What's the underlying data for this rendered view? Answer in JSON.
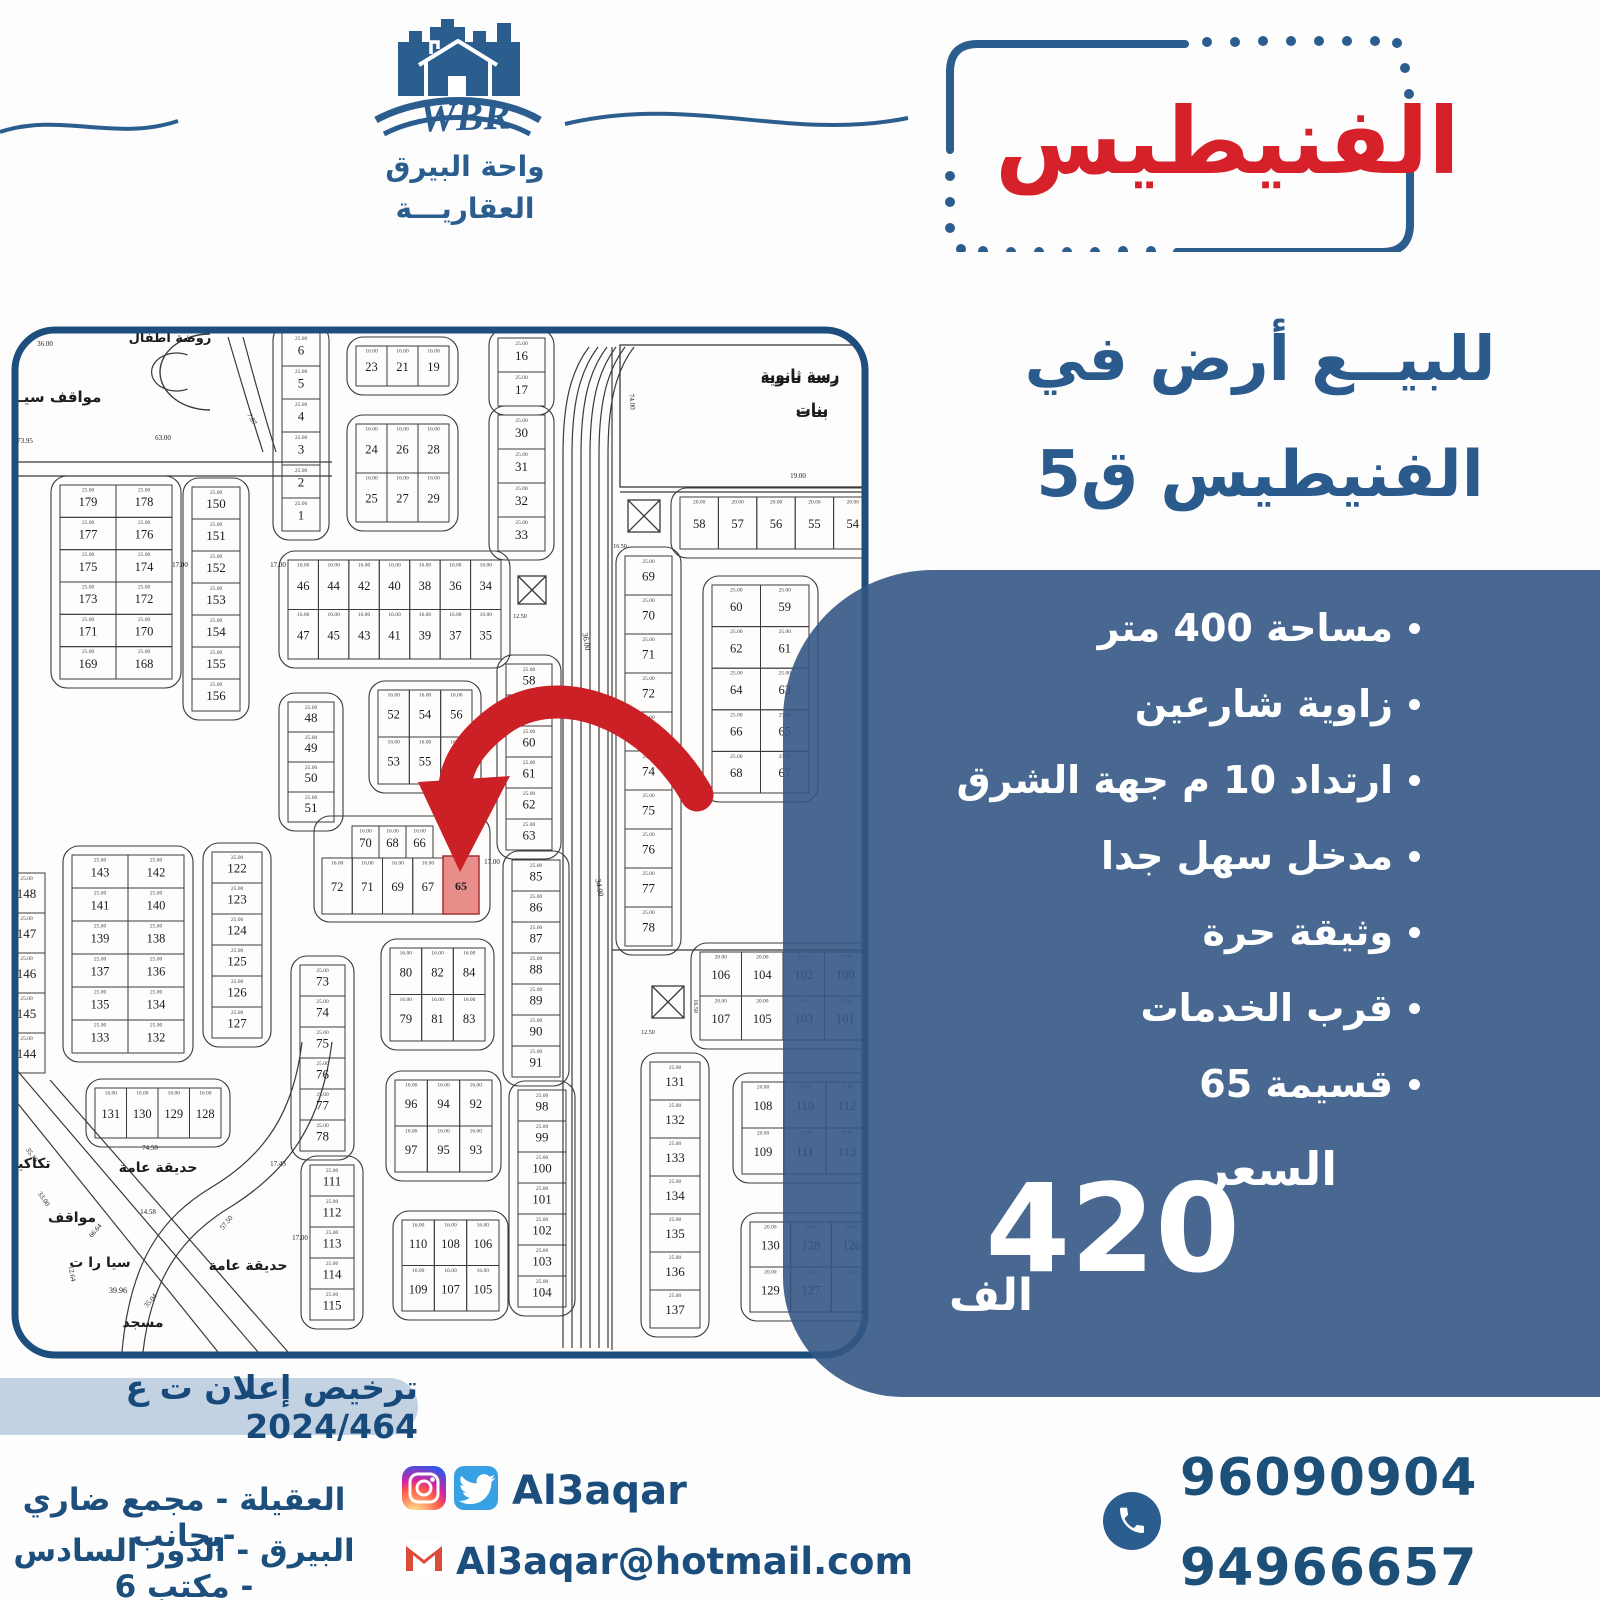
{
  "brand": {
    "wbr": "WBR",
    "name_line1": "واحة البيرق",
    "name_line2": "العقاريـــة"
  },
  "title_box": {
    "title": "الفنيطيس",
    "accent_color": "#d6212b",
    "border_color": "#2b5d8f"
  },
  "headline": {
    "line1": "للبيــع أرض في",
    "line2": "الفنيطيس ق5"
  },
  "offer": {
    "panel_color": "rgba(52,88,133,0.9)",
    "bullets": [
      "مساحة 400 متر",
      "زاوية شارعين",
      "ارتداد 10 م جهة الشرق",
      "مدخل سهل جدا",
      "وثيقة حرة",
      "قرب الخدمات",
      "قسيمة 65"
    ],
    "price_label": "السعر",
    "price_value": "420",
    "price_unit": "الف"
  },
  "license": {
    "text": "ترخيص إعلان ت ع 2024/464"
  },
  "contact": {
    "address_line1": "العقيلة - مجمع ضاري -بجانب",
    "address_line2": "البيرق - الدور السادس - مكتب 6",
    "social_handle": "Al3aqar",
    "email": "Al3aqar@hotmail.com",
    "phone1": "96090904",
    "phone2": "94966657"
  },
  "icons": {
    "instagram": "instagram-icon",
    "twitter": "twitter-icon",
    "gmail": "gmail-icon",
    "phone": "phone-icon"
  },
  "map": {
    "ink": "#3a3a3a",
    "frame": {
      "x": 15,
      "y": 330,
      "w": 850,
      "h": 1025,
      "r": 40,
      "stroke": "#1d4e7e"
    },
    "corridor_x": [
      563,
      572,
      581,
      590,
      599,
      608
    ],
    "roads": [
      "M15,462 H332",
      "M15,476 H332",
      "M228,337 C240,378 252,418 263,452",
      "M243,337 C254,378 265,418 276,452",
      "M15,1068 L258,1352",
      "M15,1100 L218,1352",
      "M50,1080 L288,1352",
      "M332,1042 C322,1120 292,1168 232,1206 C185,1234 152,1274 143,1352",
      "M302,1042 C294,1110 267,1154 212,1187 C162,1217 130,1260 122,1352",
      "M612,347 V1350",
      "M620,492 H868",
      "M612,950 H868"
    ],
    "strips": [
      {
        "x": 282,
        "y": 333,
        "w": 38,
        "ph": 33,
        "n": [
          "6",
          "5",
          "4",
          "3",
          "2",
          "1"
        ],
        "o": 1,
        "d": "25.00"
      },
      {
        "x": 192,
        "y": 487,
        "w": 48,
        "ph": 32,
        "n": [
          "150",
          "151",
          "152",
          "153",
          "154",
          "155",
          "156"
        ],
        "o": 1,
        "d": "25.00"
      },
      {
        "x": 288,
        "y": 702,
        "w": 46,
        "ph": 30,
        "n": [
          "48",
          "49",
          "50",
          "51"
        ],
        "o": 1,
        "d": "25.00"
      },
      {
        "x": 212,
        "y": 852,
        "w": 50,
        "ph": 31,
        "n": [
          "122",
          "123",
          "124",
          "125",
          "126",
          "127"
        ],
        "o": 1,
        "d": "25.00"
      },
      {
        "x": 300,
        "y": 965,
        "w": 45,
        "ph": 31,
        "n": [
          "73",
          "74",
          "75",
          "76",
          "77",
          "78"
        ],
        "o": 1,
        "d": "25.00"
      },
      {
        "x": 310,
        "y": 1165,
        "w": 44,
        "ph": 31,
        "n": [
          "111",
          "112",
          "113",
          "114",
          "115"
        ],
        "o": 1,
        "d": "25.00"
      },
      {
        "x": 8,
        "y": 873,
        "w": 37,
        "ph": 40,
        "n": [
          "148",
          "147",
          "146",
          "145",
          "144"
        ],
        "o": 0,
        "d": "25.00"
      },
      {
        "x": 498,
        "y": 338,
        "w": 47,
        "ph": 34,
        "n": [
          "16",
          "17"
        ],
        "o": 1,
        "d": "25.00"
      },
      {
        "x": 498,
        "y": 415,
        "w": 47,
        "ph": 34,
        "n": [
          "30",
          "31",
          "32",
          "33"
        ],
        "o": 1,
        "d": "25.00"
      },
      {
        "x": 506,
        "y": 664,
        "w": 46,
        "ph": 31,
        "n": [
          "58",
          "59",
          "60",
          "61",
          "62",
          "63"
        ],
        "o": 1,
        "d": "25.00"
      },
      {
        "x": 512,
        "y": 860,
        "w": 48,
        "ph": 31,
        "n": [
          "85",
          "86",
          "87",
          "88",
          "89",
          "90",
          "91"
        ],
        "o": 1,
        "d": "25.00"
      },
      {
        "x": 518,
        "y": 1090,
        "w": 48,
        "ph": 31,
        "n": [
          "98",
          "99",
          "100",
          "101",
          "102",
          "103",
          "104"
        ],
        "o": 1,
        "d": "25.00"
      },
      {
        "x": 625,
        "y": 556,
        "w": 47,
        "ph": 39,
        "n": [
          "69",
          "70",
          "71",
          "72",
          "73",
          "74",
          "75",
          "76",
          "77",
          "78"
        ],
        "o": 1,
        "d": "25.00"
      },
      {
        "x": 650,
        "y": 1062,
        "w": 50,
        "ph": 38,
        "n": [
          "131",
          "132",
          "133",
          "134",
          "135",
          "136",
          "137"
        ],
        "o": 1,
        "d": "25.00"
      }
    ],
    "grids": [
      {
        "x": 356,
        "y": 346,
        "w": 93,
        "h": 40,
        "n": [
          [
            "23",
            "21",
            "19"
          ]
        ],
        "o": 1,
        "d": "16.00"
      },
      {
        "x": 356,
        "y": 424,
        "w": 93,
        "h": 98,
        "n": [
          [
            "24",
            "26",
            "28"
          ],
          [
            "25",
            "27",
            "29"
          ]
        ],
        "o": 1,
        "d": "16.00"
      },
      {
        "x": 60,
        "y": 485,
        "w": 112,
        "h": 194,
        "n": [
          [
            "179",
            "178"
          ],
          [
            "177",
            "176"
          ],
          [
            "175",
            "174"
          ],
          [
            "173",
            "172"
          ],
          [
            "171",
            "170"
          ],
          [
            "169",
            "168"
          ]
        ],
        "o": 1,
        "d": "25.00"
      },
      {
        "x": 288,
        "y": 560,
        "w": 213,
        "h": 99,
        "n": [
          [
            "46",
            "44",
            "42",
            "40",
            "38",
            "36",
            "34"
          ],
          [
            "47",
            "45",
            "43",
            "41",
            "39",
            "37",
            "35"
          ]
        ],
        "o": 1,
        "d": "16.00"
      },
      {
        "x": 378,
        "y": 690,
        "w": 94,
        "h": 94,
        "n": [
          [
            "52",
            "54",
            "56"
          ],
          [
            "53",
            "55",
            "57"
          ]
        ],
        "o": 1,
        "d": "16.00"
      },
      {
        "x": 352,
        "y": 826,
        "w": 81,
        "h": 32,
        "n": [
          [
            "70",
            "68",
            "66"
          ]
        ],
        "o": 0,
        "d": "16.00"
      },
      {
        "x": 322,
        "y": 858,
        "w": 121,
        "h": 56,
        "n": [
          [
            "72",
            "71",
            "69",
            "67"
          ]
        ],
        "o": 0,
        "d": "16.00"
      },
      {
        "x": 390,
        "y": 948,
        "w": 95,
        "h": 93,
        "n": [
          [
            "80",
            "82",
            "84"
          ],
          [
            "79",
            "81",
            "83"
          ]
        ],
        "o": 1,
        "d": "16.00"
      },
      {
        "x": 395,
        "y": 1080,
        "w": 97,
        "h": 92,
        "n": [
          [
            "96",
            "94",
            "92"
          ],
          [
            "97",
            "95",
            "93"
          ]
        ],
        "o": 1,
        "d": "16.00"
      },
      {
        "x": 402,
        "y": 1220,
        "w": 97,
        "h": 91,
        "n": [
          [
            "110",
            "108",
            "106"
          ],
          [
            "109",
            "107",
            "105"
          ]
        ],
        "o": 1,
        "d": "16.00"
      },
      {
        "x": 72,
        "y": 855,
        "w": 112,
        "h": 198,
        "n": [
          [
            "143",
            "142"
          ],
          [
            "141",
            "140"
          ],
          [
            "139",
            "138"
          ],
          [
            "137",
            "136"
          ],
          [
            "135",
            "134"
          ],
          [
            "133",
            "132"
          ]
        ],
        "o": 1,
        "d": "25.00"
      },
      {
        "x": 95,
        "y": 1088,
        "w": 126,
        "h": 50,
        "n": [
          [
            "131",
            "130",
            "129",
            "128"
          ]
        ],
        "o": 1,
        "d": "16.00"
      },
      {
        "x": 712,
        "y": 585,
        "w": 97,
        "h": 208,
        "n": [
          [
            "60",
            "59"
          ],
          [
            "62",
            "61"
          ],
          [
            "64",
            "63"
          ],
          [
            "66",
            "65"
          ],
          [
            "68",
            "67"
          ]
        ],
        "o": 1,
        "d": "25.00"
      },
      {
        "x": 680,
        "y": 497,
        "w": 192,
        "h": 52,
        "n": [
          [
            "58",
            "57",
            "56",
            "55",
            "54"
          ]
        ],
        "o": 1,
        "d": "20.00"
      },
      {
        "x": 700,
        "y": 952,
        "w": 166,
        "h": 88,
        "n": [
          [
            "106",
            "104",
            "102",
            "100"
          ],
          [
            "107",
            "105",
            "103",
            "101"
          ]
        ],
        "o": 1,
        "d": "20.00"
      },
      {
        "x": 742,
        "y": 1082,
        "w": 126,
        "h": 92,
        "n": [
          [
            "108",
            "110",
            "112"
          ],
          [
            "109",
            "111",
            "113"
          ]
        ],
        "o": 1,
        "d": "20.00"
      },
      {
        "x": 750,
        "y": 1222,
        "w": 122,
        "h": 90,
        "n": [
          [
            "130",
            "128",
            "126"
          ],
          [
            "129",
            "127",
            ""
          ]
        ],
        "o": 1,
        "d": "20.00"
      }
    ],
    "outlines": [
      [
        314,
        816,
        176,
        106
      ]
    ],
    "xmarks": [
      [
        518,
        576,
        28
      ],
      [
        628,
        500,
        32
      ],
      [
        652,
        986,
        32
      ]
    ],
    "school": {
      "x": 620,
      "y": 345,
      "w": 248,
      "h": 142,
      "l1": "رسة ثانوية",
      "l2": "بنات"
    },
    "cbuild": {
      "cx": 160,
      "cy": 372,
      "rx": 50,
      "ry": 38
    },
    "labels": [
      {
        "t": "روضة أطفال",
        "x": 170,
        "y": 342,
        "s": 13,
        "b": 1
      },
      {
        "t": "مواقف سيـ",
        "x": 60,
        "y": 402,
        "s": 15,
        "b": 1
      },
      {
        "t": "73.95",
        "x": 25,
        "y": 443,
        "s": 7
      },
      {
        "t": "36.00",
        "x": 45,
        "y": 346,
        "s": 7
      },
      {
        "t": "63.00",
        "x": 163,
        "y": 440,
        "s": 7
      },
      {
        "t": "7.87",
        "x": 250,
        "y": 420,
        "s": 7,
        "r": 60
      },
      {
        "t": "17.00",
        "x": 180,
        "y": 567,
        "s": 7
      },
      {
        "t": "17.00",
        "x": 278,
        "y": 567,
        "s": 7
      },
      {
        "t": "12.50",
        "x": 520,
        "y": 618,
        "s": 6
      },
      {
        "t": "36.00",
        "x": 584,
        "y": 642,
        "s": 8,
        "r": 80
      },
      {
        "t": "34.00",
        "x": 597,
        "y": 888,
        "s": 8,
        "r": 80
      },
      {
        "t": "رسة ثانوية",
        "x": 800,
        "y": 380,
        "s": 15,
        "b": 1
      },
      {
        "t": "بنات",
        "x": 812,
        "y": 414,
        "s": 15,
        "b": 1
      },
      {
        "t": "74.00",
        "x": 630,
        "y": 402,
        "s": 7,
        "r": 85
      },
      {
        "t": "19.00",
        "x": 798,
        "y": 478,
        "s": 7
      },
      {
        "t": "16.50",
        "x": 620,
        "y": 548,
        "s": 6
      },
      {
        "t": "12.50",
        "x": 648,
        "y": 1034,
        "s": 6
      },
      {
        "t": "16.50",
        "x": 694,
        "y": 1006,
        "s": 6,
        "r": 90
      },
      {
        "t": "حديقة عامة",
        "x": 158,
        "y": 1172,
        "s": 14,
        "b": 1
      },
      {
        "t": "حديقة عامة",
        "x": 248,
        "y": 1270,
        "s": 14,
        "b": 1
      },
      {
        "t": "74.50",
        "x": 150,
        "y": 1150,
        "s": 7
      },
      {
        "t": "14.58",
        "x": 148,
        "y": 1214,
        "s": 7
      },
      {
        "t": "57.50",
        "x": 228,
        "y": 1224,
        "s": 7,
        "r": -50
      },
      {
        "t": "66.64",
        "x": 97,
        "y": 1232,
        "s": 7,
        "r": -50
      },
      {
        "t": "39.96",
        "x": 118,
        "y": 1293,
        "s": 8
      },
      {
        "t": "35.04",
        "x": 152,
        "y": 1302,
        "s": 7,
        "r": -50
      },
      {
        "t": "17.43",
        "x": 278,
        "y": 1166,
        "s": 7
      },
      {
        "t": "مواقف",
        "x": 72,
        "y": 1222,
        "s": 14,
        "b": 1
      },
      {
        "t": "سيا را ت",
        "x": 100,
        "y": 1267,
        "s": 14,
        "b": 1
      },
      {
        "t": "تكاكير",
        "x": 30,
        "y": 1168,
        "s": 14,
        "b": 1
      },
      {
        "t": "مسجد",
        "x": 143,
        "y": 1327,
        "s": 14,
        "b": 1
      },
      {
        "t": "35.19",
        "x": 30,
        "y": 1156,
        "s": 7,
        "r": 55
      },
      {
        "t": "33.00",
        "x": 42,
        "y": 1200,
        "s": 7,
        "r": 55
      },
      {
        "t": "12.64",
        "x": 70,
        "y": 1274,
        "s": 7,
        "r": 80
      },
      {
        "t": "17.00",
        "x": 492,
        "y": 864,
        "s": 7
      },
      {
        "t": "17.00",
        "x": 300,
        "y": 1240,
        "s": 7
      }
    ],
    "highlight": {
      "x": 443,
      "y": 856,
      "w": 36,
      "h": 58,
      "n": "65",
      "fill": "#e4716f",
      "stroke": "#a23030"
    },
    "arrow": {
      "color": "#cb2026",
      "d": "M 697 795 C 650 712, 558 678, 500 720 C 470 742, 457 765, 455 786",
      "head": "418,782 510,776 460,872"
    }
  }
}
